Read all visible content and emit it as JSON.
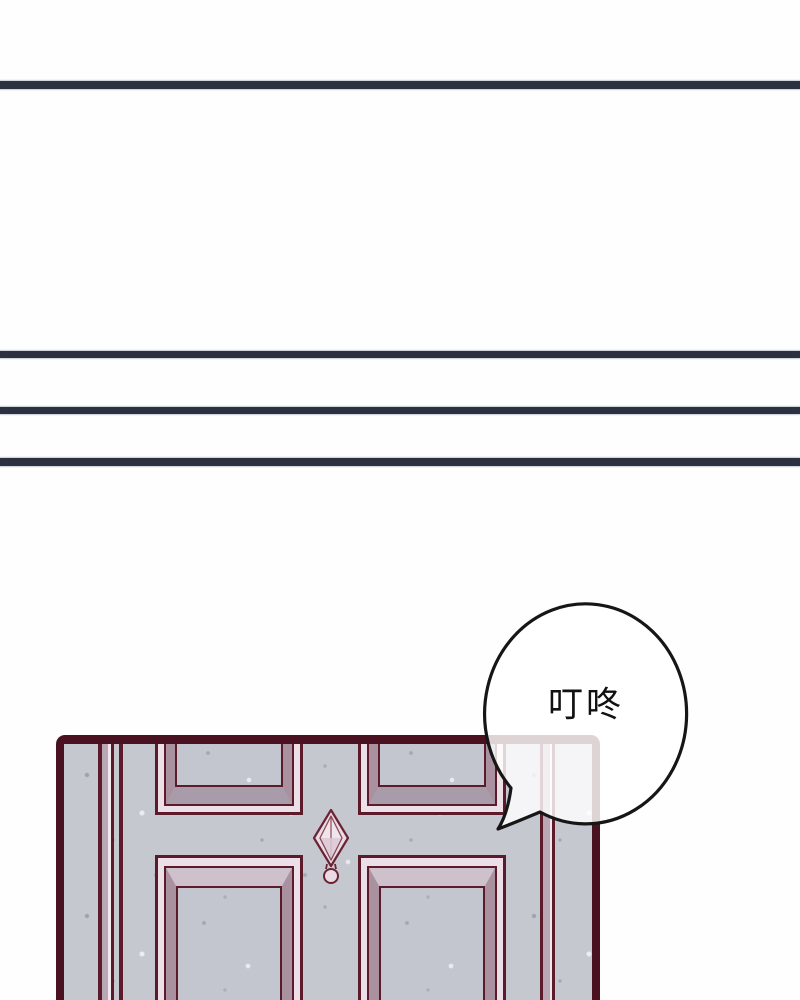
{
  "page": {
    "kind": "comic page",
    "background_color": "#fefefe"
  },
  "divider_lines": {
    "color": "#2b3140",
    "count": 4
  },
  "empty_panels": {
    "tall_panel_fill": "#ffffff",
    "narrow_panel_fill": "#ffffff"
  },
  "speech_bubble": {
    "text": "叮咚",
    "fill": "#ffffff",
    "fill_opacity": 0.82,
    "stroke_color": "#161616",
    "text_color": "#111111"
  },
  "door": {
    "frame_color": "#4a1220",
    "outline_color": "#5c1b2b",
    "surface_color": "#c5c8cf",
    "bevel_highlight_color": "#eddfe7",
    "bevel_mauve_color": "#a9919f",
    "bevel_shadow_color": "#a89cab",
    "trim_light_color": "#f0e8ee",
    "trim_mauve_color": "#b9a7b3",
    "panel_count": 4,
    "ornament": "diamond-finial"
  }
}
